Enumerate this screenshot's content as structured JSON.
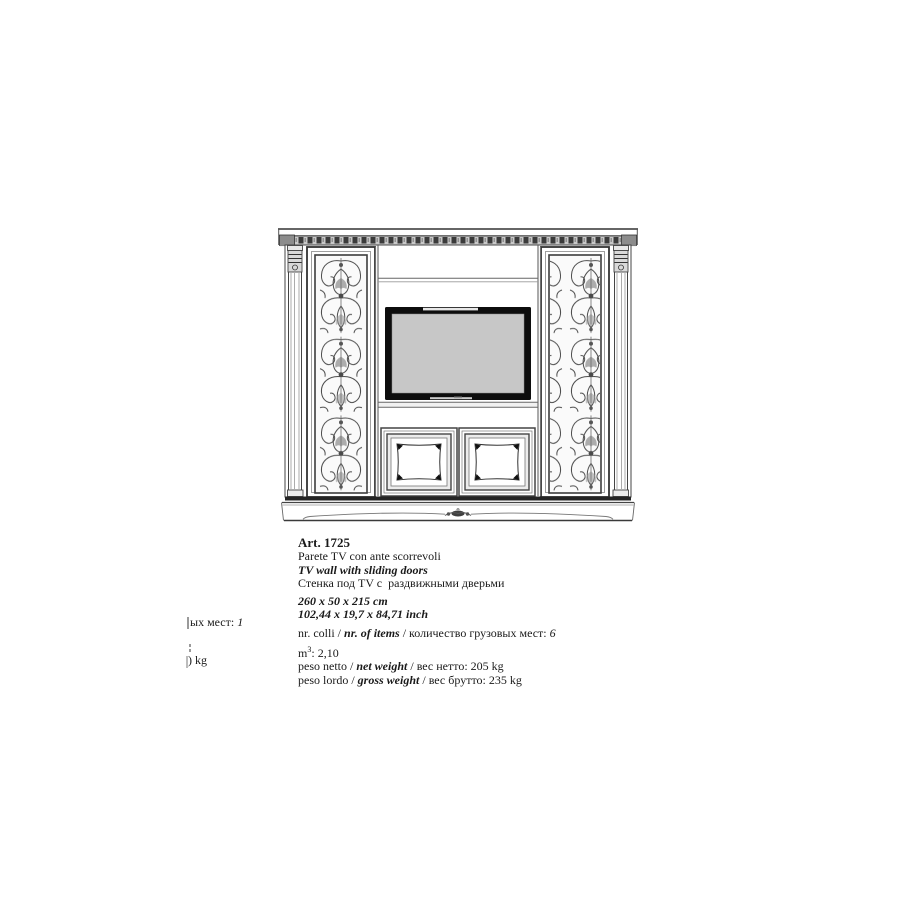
{
  "palette": {
    "paper": "#ffffff",
    "ink": "#1a1a1a",
    "line": "#444444",
    "screen_gray": "#c7c7c7"
  },
  "separators": {
    "slash": " / ",
    "colon": ": "
  },
  "product": {
    "art": "Art. 1725",
    "name_it": "Parete TV con ante scorrevoli",
    "name_en": "TV wall with sliding doors",
    "name_ru": "Стенка под TV с  раздвижными дверьми",
    "size_cm": "260 x 50 x 215 cm",
    "size_inch": "102,44 x 19,7 x 84,71 inch",
    "items": {
      "label_it": "nr. colli",
      "label_en": "nr. of items",
      "label_ru": "количество грузовых мест",
      "value": "6"
    },
    "volume": {
      "label": "m",
      "sup": "3",
      "value": "2,10"
    },
    "net_weight": {
      "label_it": "peso netto",
      "label_en": "net weight",
      "label_ru": "вес нетто",
      "value": "205 kg"
    },
    "gross_weight": {
      "label_it": "peso lordo",
      "label_en": "gross weight",
      "label_ru": "вес брутто",
      "value": "235 kg"
    }
  },
  "fragments": {
    "line1_text": "ых мест:",
    "line1_value": "1",
    "line2": ") kg"
  },
  "drawing": {
    "caption": "TV wall unit with carved side panels, central TV niche and two lower doors"
  }
}
